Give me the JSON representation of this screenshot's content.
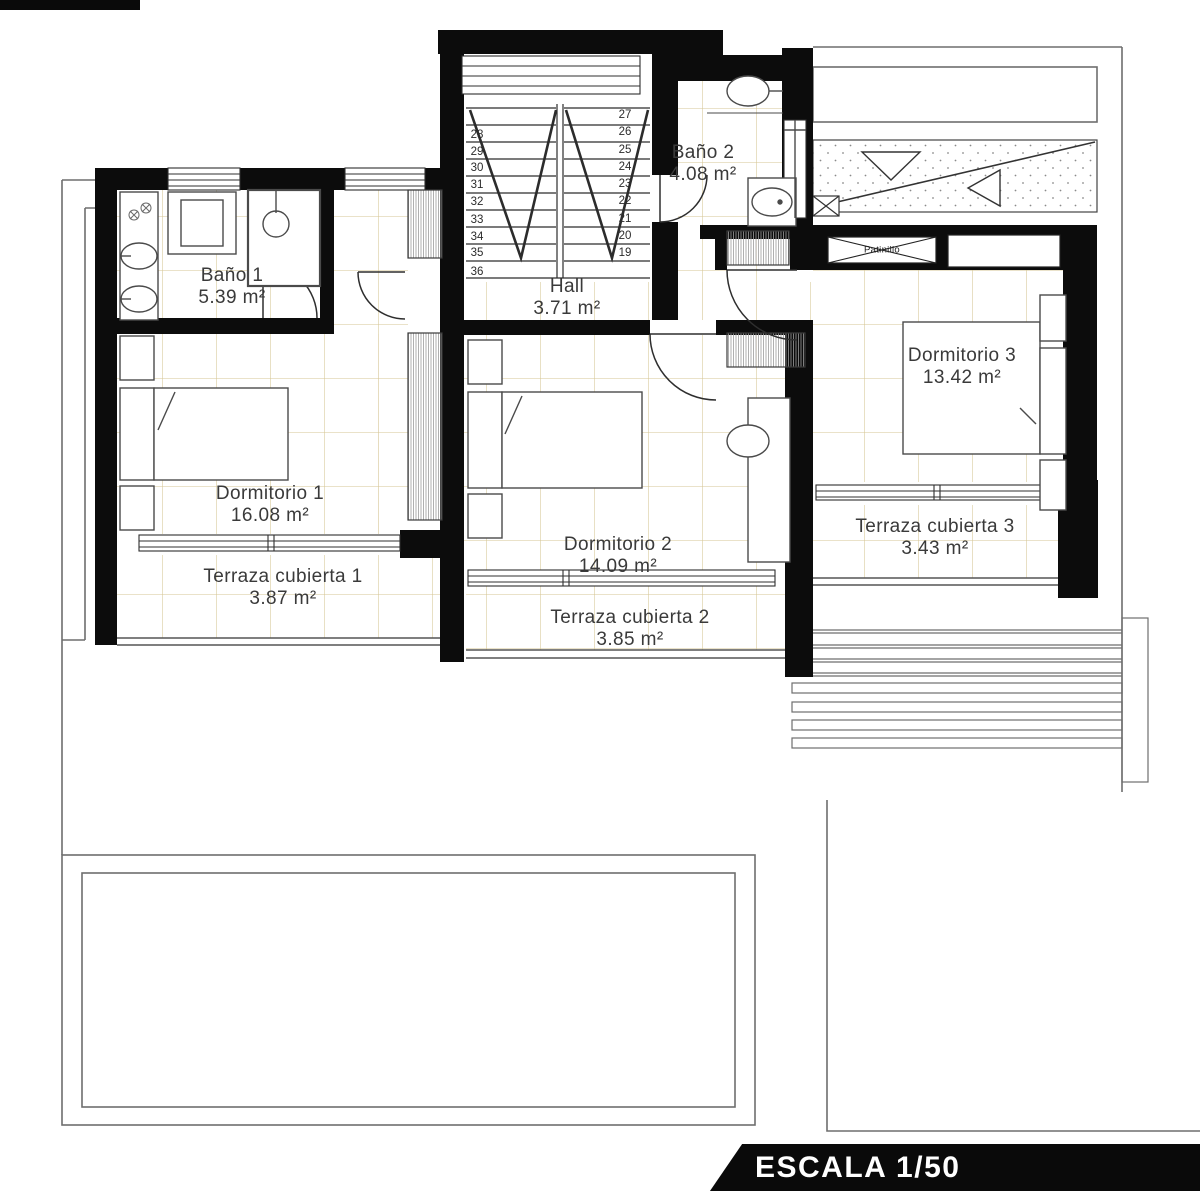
{
  "scale_label": "ESCALA 1/50",
  "shaft_label": "Patinillo",
  "rooms": {
    "bano1": {
      "name": "Baño 1",
      "area": "5.39 m²"
    },
    "bano2": {
      "name": "Baño 2",
      "area": "4.08 m²"
    },
    "hall": {
      "name": "Hall",
      "area": "3.71 m²"
    },
    "dormitorio1": {
      "name": "Dormitorio 1",
      "area": "16.08 m²"
    },
    "dormitorio2": {
      "name": "Dormitorio 2",
      "area": "14.09 m²"
    },
    "dormitorio3": {
      "name": "Dormitorio 3",
      "area": "13.42 m²"
    },
    "terraza1": {
      "name": "Terraza cubierta 1",
      "area": "3.87 m²"
    },
    "terraza2": {
      "name": "Terraza cubierta 2",
      "area": "3.85 m²"
    },
    "terraza3": {
      "name": "Terraza cubierta 3",
      "area": "3.43 m²"
    }
  },
  "stairs": {
    "left": [
      "28",
      "29",
      "30",
      "31",
      "32",
      "33",
      "34",
      "35",
      "36"
    ],
    "right": [
      "27",
      "26",
      "25",
      "24",
      "23",
      "22",
      "21",
      "20",
      "19"
    ]
  },
  "colors": {
    "wall": "#0c0c0c",
    "tile_line": "#d3c28e",
    "site_line": "#6e6e6e",
    "banner_bg": "#0a0a0a"
  }
}
